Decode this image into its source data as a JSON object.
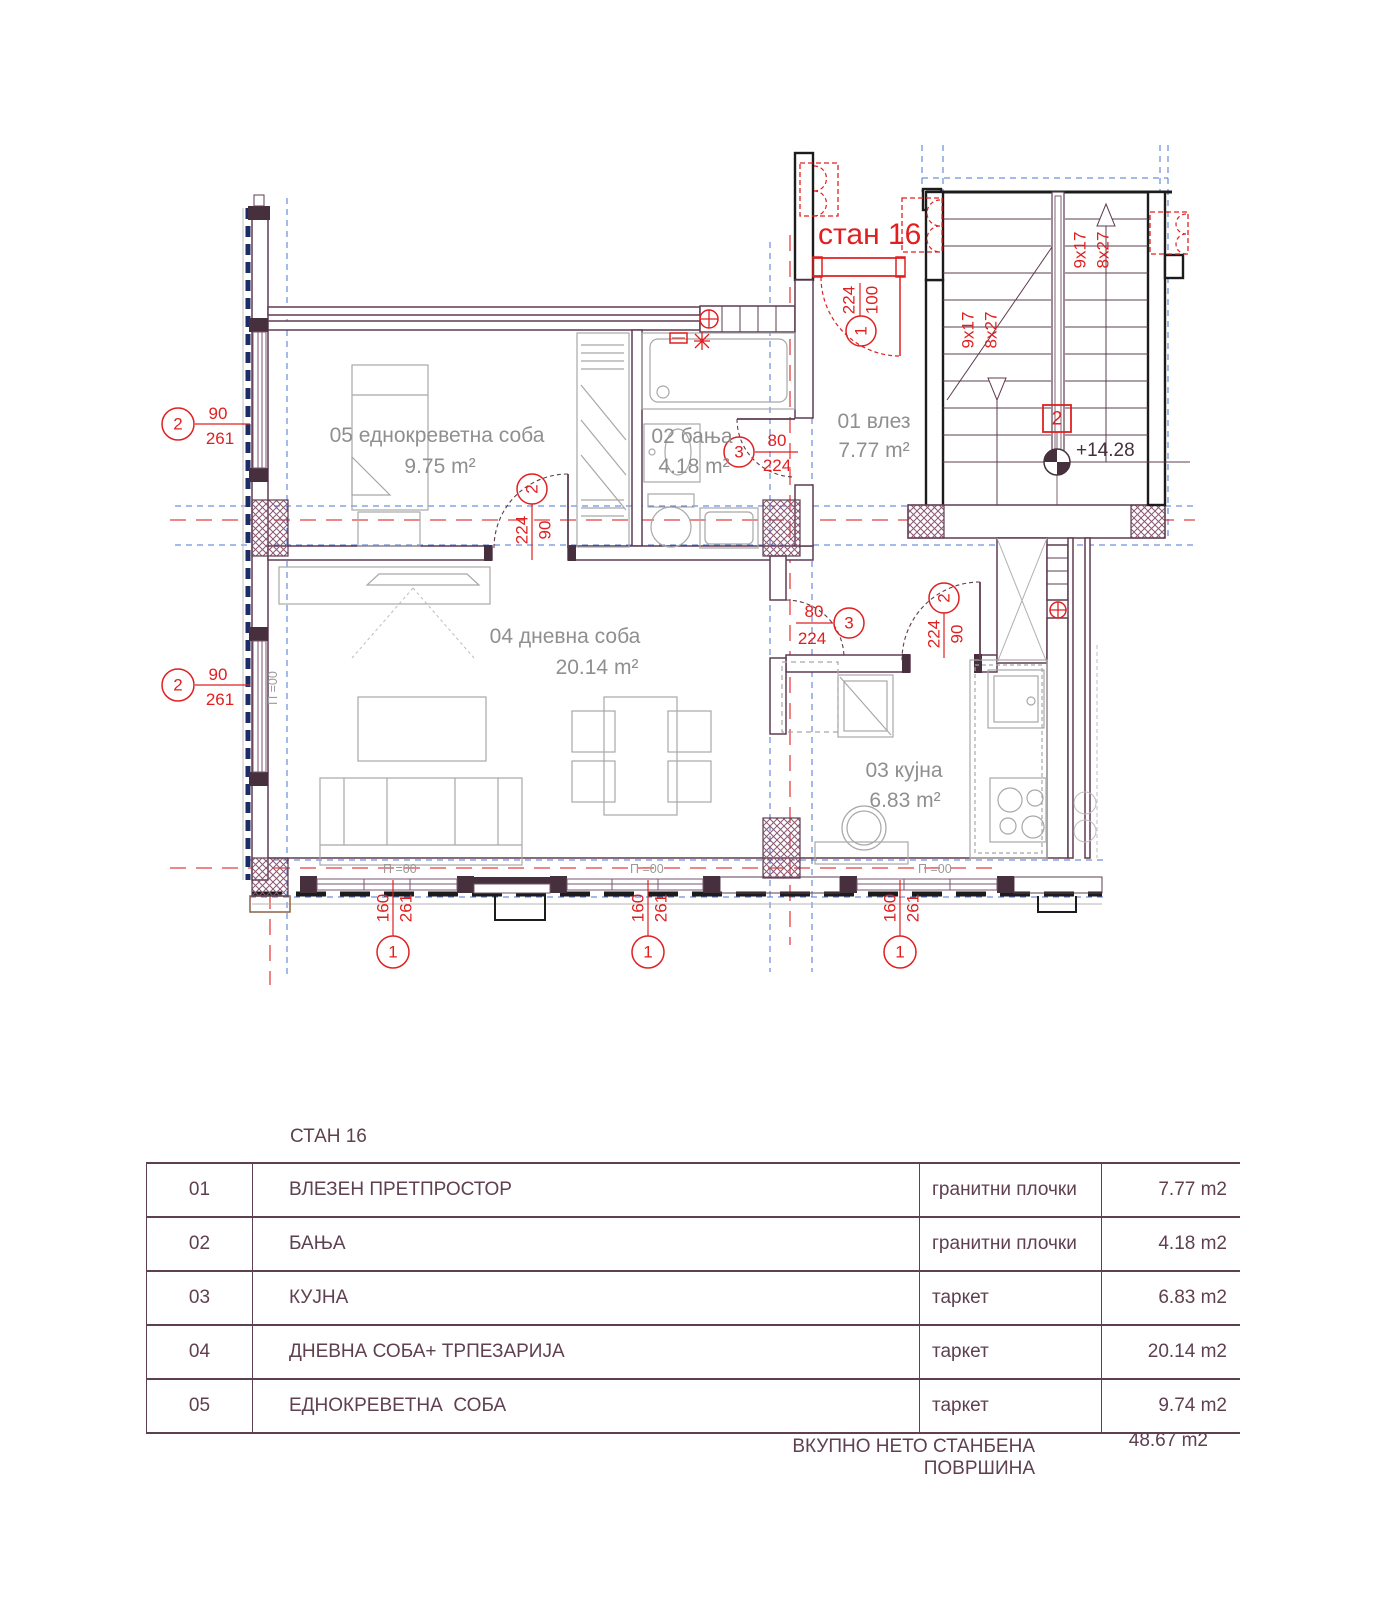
{
  "plan": {
    "apartment_title": "стан 16",
    "rooms": {
      "entry": {
        "label": "01 влез",
        "area": "7.77 m²"
      },
      "bath": {
        "label": "02 бања",
        "area": "4.18 m²"
      },
      "kitchen": {
        "label": "03 кујна",
        "area": "6.83 m²"
      },
      "living": {
        "label": "04 дневна соба",
        "area": "20.14 m²"
      },
      "bedroom": {
        "label": "05 еднокреветна соба",
        "area": "9.75 m²"
      }
    },
    "levels": {
      "floor": "П =00",
      "stair_elevation": "+14.28"
    },
    "stair": {
      "flight_label_1": "9x17",
      "flight_label_2": "8x27",
      "flight_number": "2"
    },
    "openings": {
      "entry_door": {
        "marker": "1",
        "width": "100",
        "height": "224"
      },
      "bedroom_door": {
        "marker": "2",
        "width": "90",
        "height": "224"
      },
      "bath_door": {
        "marker": "3",
        "width": "80",
        "height": "224"
      },
      "living_kitchen_door": {
        "marker": "3",
        "width": "80",
        "height": "224"
      },
      "kitchen_door": {
        "marker": "2",
        "width": "90",
        "height": "224"
      },
      "window_left": {
        "marker": "2",
        "width": "90",
        "height": "261"
      },
      "window_bottom": {
        "marker": "1",
        "width": "160",
        "height": "261"
      }
    }
  },
  "table": {
    "title": "СТАН 16",
    "rows": [
      {
        "num": "01",
        "name": "ВЛЕЗЕН ПРЕТПРОСТОР",
        "finish": "гранитни плочки",
        "area": "7.77 m2"
      },
      {
        "num": "02",
        "name": "БАЊА",
        "finish": "гранитни плочки",
        "area": "4.18 m2"
      },
      {
        "num": "03",
        "name": "КУЈНА",
        "finish": "таркет",
        "area": "6.83 m2"
      },
      {
        "num": "04",
        "name": "ДНЕВНА СОБА+ ТРПЕЗАРИЈА",
        "finish": "таркет",
        "area": "20.14 m2"
      },
      {
        "num": "05",
        "name": "ЕДНОКРЕВЕТНА  СОБА",
        "finish": "таркет",
        "area": "9.74 m2"
      }
    ],
    "total_label": "ВКУПНО НЕТО СТАНБЕНА ПОВРШИНА",
    "total_value": "48.67 m2"
  },
  "colors": {
    "annotation_red": "#e02020",
    "wall_maroon": "#5e3c50",
    "wall_dark_fill": "#46303e",
    "axis_blue": "#4a74d4",
    "insulation_navy": "#1e2c66",
    "furniture_gray": "#a8a8a8",
    "label_gray": "#8f8f8f",
    "table_maroon": "#5f4050",
    "step_brown": "#8a6248"
  }
}
